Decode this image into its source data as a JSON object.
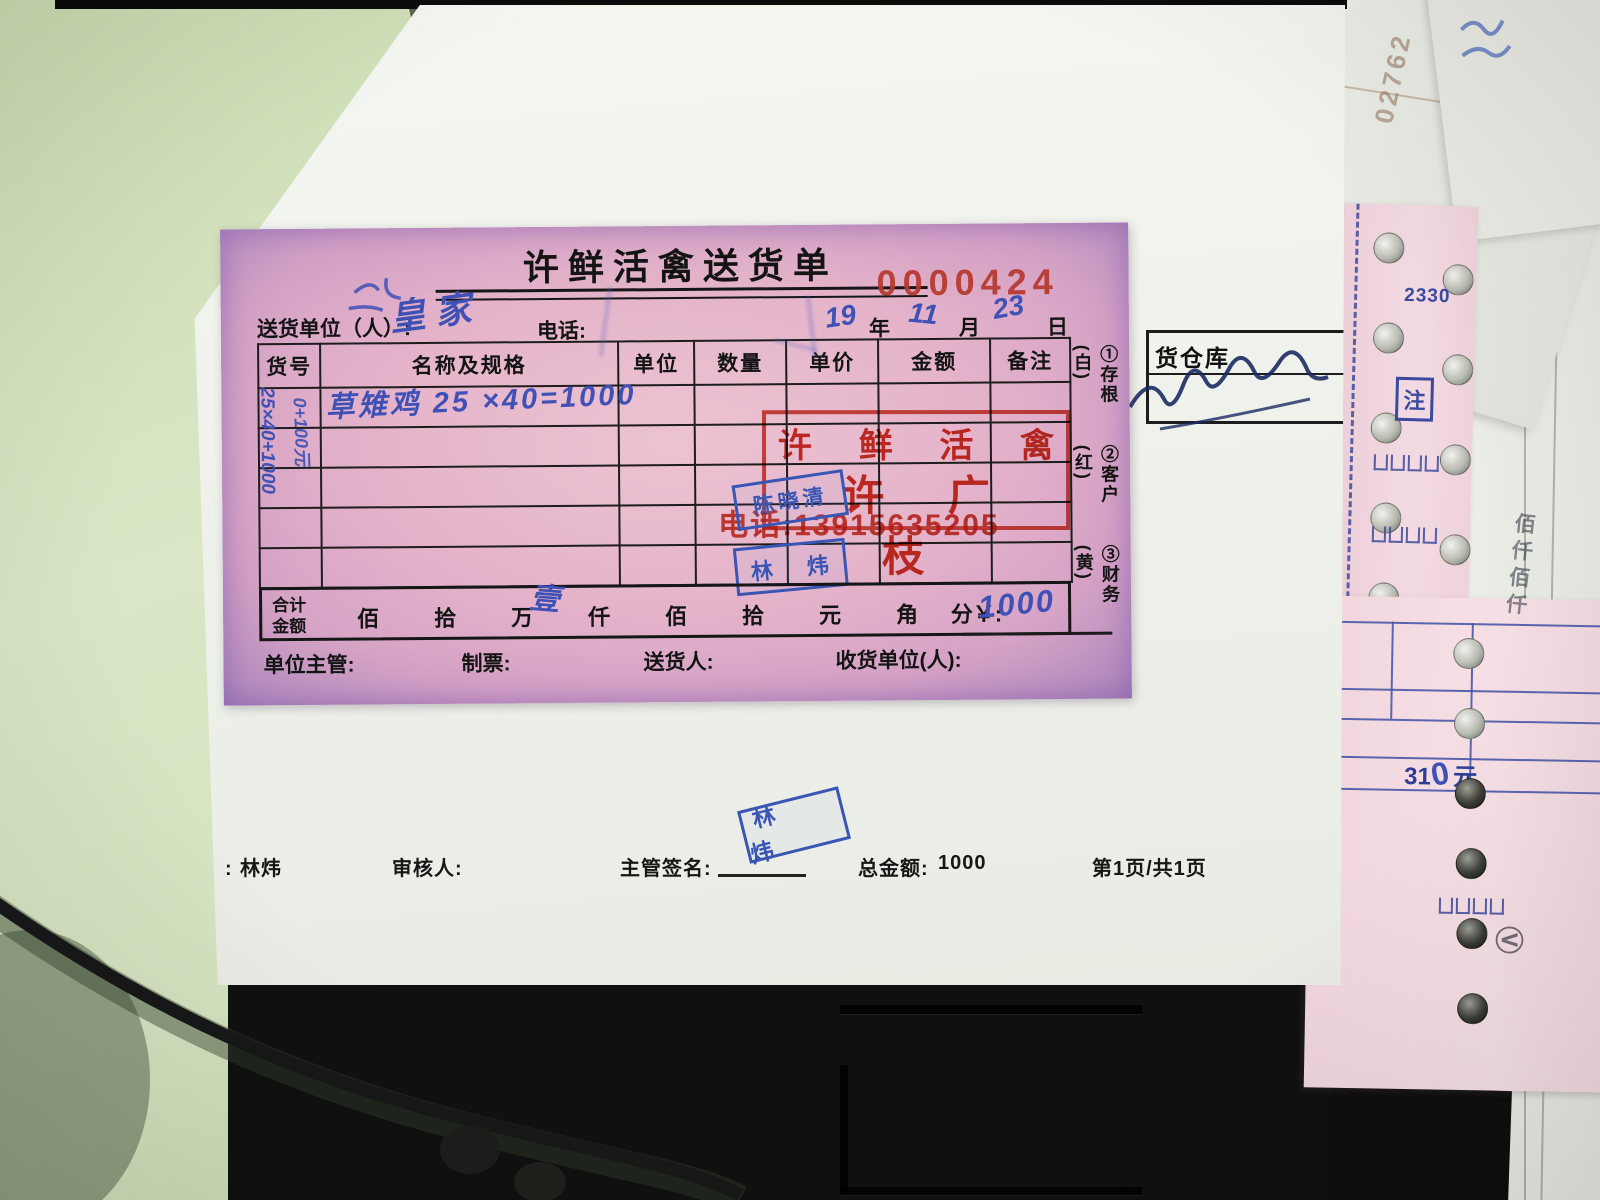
{
  "form": {
    "title": "许鲜活禽送货单",
    "serial": "0000424",
    "sender_label": "送货单位（人）:",
    "sender_handwritten": "皇家",
    "phone_label": "电话:",
    "date_year": "19",
    "date_year_suffix": "年",
    "date_month": "11",
    "date_month_suffix": "月",
    "date_day": "23",
    "date_day_suffix": "日",
    "table_headers": {
      "h0": "货号",
      "h1": "名称及规格",
      "h2": "单位",
      "h3": "数量",
      "h4": "单价",
      "h5": "金额",
      "h6": "备注"
    },
    "row1_text": "草雉鸡  25 ×40=1000",
    "margin_scribble_1": "25×40+1000",
    "margin_scribble_2": "0+100元",
    "copies": {
      "c1": "①存根(白)",
      "c2": "②客户(红)",
      "c3": "③财务(黄)"
    },
    "red_stamp": {
      "line1_a": "许",
      "line1_b": "鲜",
      "line1_c": "活",
      "line1_d": "禽",
      "line2": "许 广 枝",
      "phone": "电话:13915635205"
    },
    "stamp_chen": "陈晓清",
    "stamp_lin": "林 炜",
    "totals": {
      "label_top": "合计",
      "label_bottom": "金额",
      "u0": "佰",
      "u1": "拾",
      "u2": "万",
      "u3": "仟",
      "u4": "佰",
      "u5": "拾",
      "u6": "元",
      "u7": "角",
      "u8": "分￥:",
      "handwritten_digit": "壹",
      "amount": "1000"
    },
    "footer": {
      "f0": "单位主管:",
      "f1": "制票:",
      "f2": "送货人:",
      "f3": "收货单位(人):"
    }
  },
  "backing": {
    "warehouse_label": "货仓库",
    "stamp_lin": "林 炜",
    "print_line": {
      "maker_prefix": "、:",
      "maker_name": "林炜",
      "reviewer": "审核人:",
      "sign_label": "主管签名:",
      "total_label": "总金额:",
      "total_value": "1000",
      "page": "第1页/共1页"
    }
  },
  "side": {
    "strip_number": "2330",
    "note_char": "注",
    "amount_prefix": "31",
    "amount_zero": "0",
    "amount_unit": "元",
    "faint_stamp": "02762",
    "vertical_chars": "佰仟佰仟",
    "circled_mark": "Ⓥ"
  }
}
